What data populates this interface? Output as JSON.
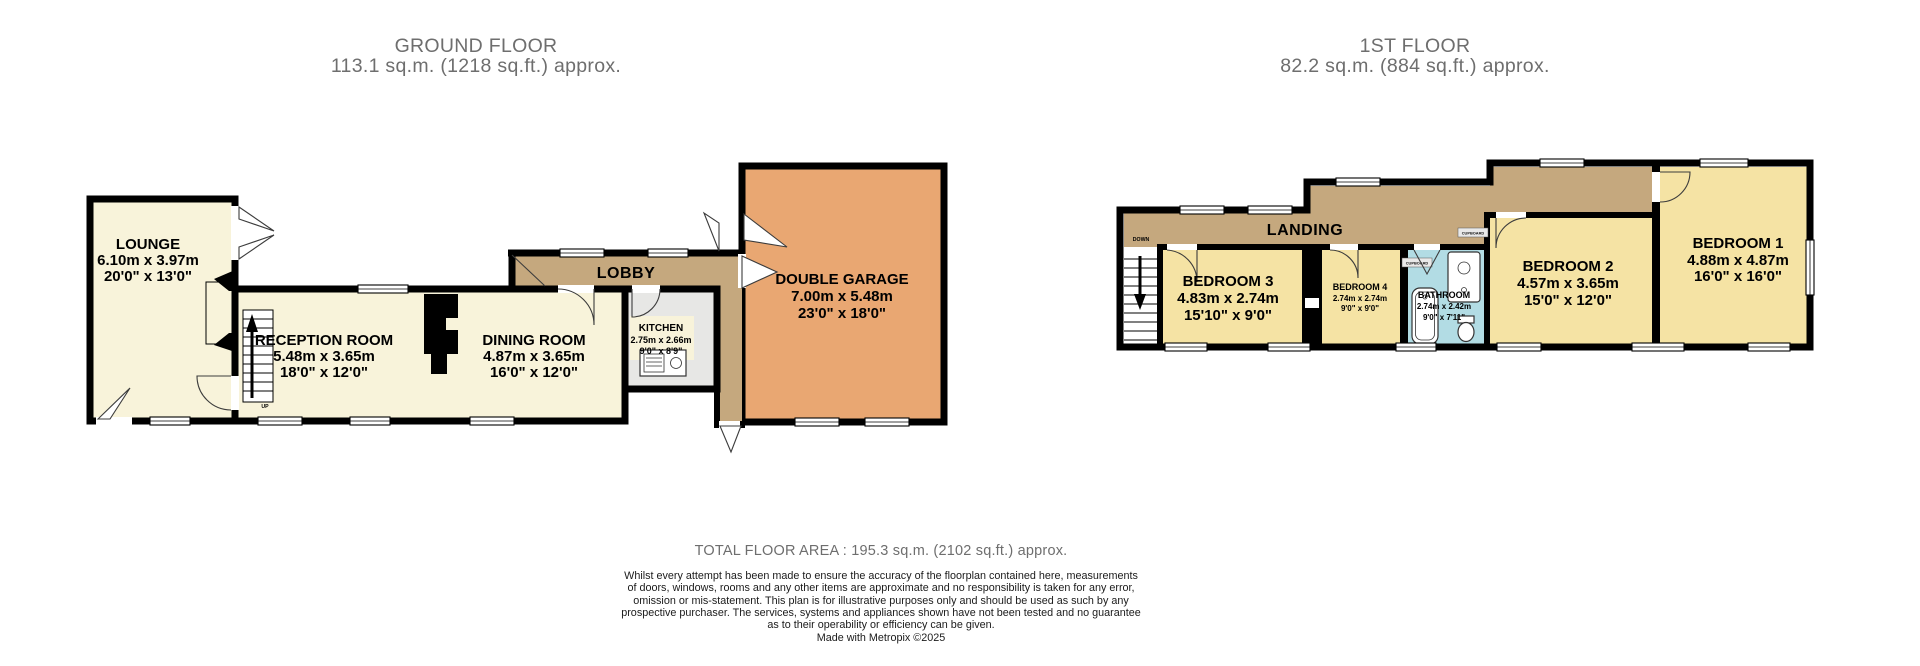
{
  "ground_floor": {
    "title": "GROUND FLOOR",
    "subtitle": "113.1 sq.m. (1218 sq.ft.) approx.",
    "rooms": {
      "lounge": {
        "name": "LOUNGE",
        "metric": "6.10m x 3.97m",
        "imperial": "20'0\" x 13'0\""
      },
      "reception": {
        "name": "RECEPTION ROOM",
        "metric": "5.48m x 3.65m",
        "imperial": "18'0\" x 12'0\""
      },
      "dining": {
        "name": "DINING ROOM",
        "metric": "4.87m x 3.65m",
        "imperial": "16'0\" x 12'0\""
      },
      "kitchen": {
        "name": "KITCHEN",
        "metric": "2.75m x 2.66m",
        "imperial": "9'0\" x 8'9\""
      },
      "garage": {
        "name": "DOUBLE GARAGE",
        "metric": "7.00m x 5.48m",
        "imperial": "23'0\" x 18'0\""
      },
      "lobby": {
        "name": "LOBBY"
      }
    },
    "stairs_label": "UP"
  },
  "first_floor": {
    "title": "1ST FLOOR",
    "subtitle": "82.2 sq.m. (884 sq.ft.) approx.",
    "rooms": {
      "landing": {
        "name": "LANDING"
      },
      "bedroom1": {
        "name": "BEDROOM 1",
        "metric": "4.88m x 4.87m",
        "imperial": "16'0\" x 16'0\""
      },
      "bedroom2": {
        "name": "BEDROOM 2",
        "metric": "4.57m x 3.65m",
        "imperial": "15'0\" x 12'0\""
      },
      "bedroom3": {
        "name": "BEDROOM 3",
        "metric": "4.83m x 2.74m",
        "imperial": "15'10\" x 9'0\""
      },
      "bedroom4": {
        "name": "BEDROOM 4",
        "metric": "2.74m x 2.74m",
        "imperial": "9'0\" x 9'0\""
      },
      "bathroom": {
        "name": "BATHROOM",
        "metric": "2.74m x 2.42m",
        "imperial": "9'0\" x 7'11\""
      }
    },
    "stairs_label": "DOWN",
    "cupboard_label": "CUPBOARD"
  },
  "footer": {
    "total_area": "TOTAL FLOOR AREA : 195.3 sq.m. (2102 sq.ft.) approx.",
    "disclaimer_lines": [
      "Whilst every attempt has been made to ensure the accuracy of the floorplan contained here, measurements",
      "of doors, windows, rooms and any other items are approximate and no responsibility is taken for any error,",
      "omission or mis-statement. This plan is for illustrative purposes only and should be used as such by any",
      "prospective purchaser. The services, systems and appliances shown have not been tested and no guarantee",
      "as to their operability or efficiency can be given."
    ],
    "credit": "Made with Metropix ©2025"
  },
  "colors": {
    "ground_room_fill": "#f8f3da",
    "first_floor_room_fill": "#f5e3a4",
    "hall_fill": "#c5a87e",
    "garage_fill": "#e9a772",
    "bathroom_fill": "#b2dce4",
    "kitchen_floor_fill": "#e7e7e5",
    "wall": "#000000",
    "title_text": "#6e6e6e"
  }
}
